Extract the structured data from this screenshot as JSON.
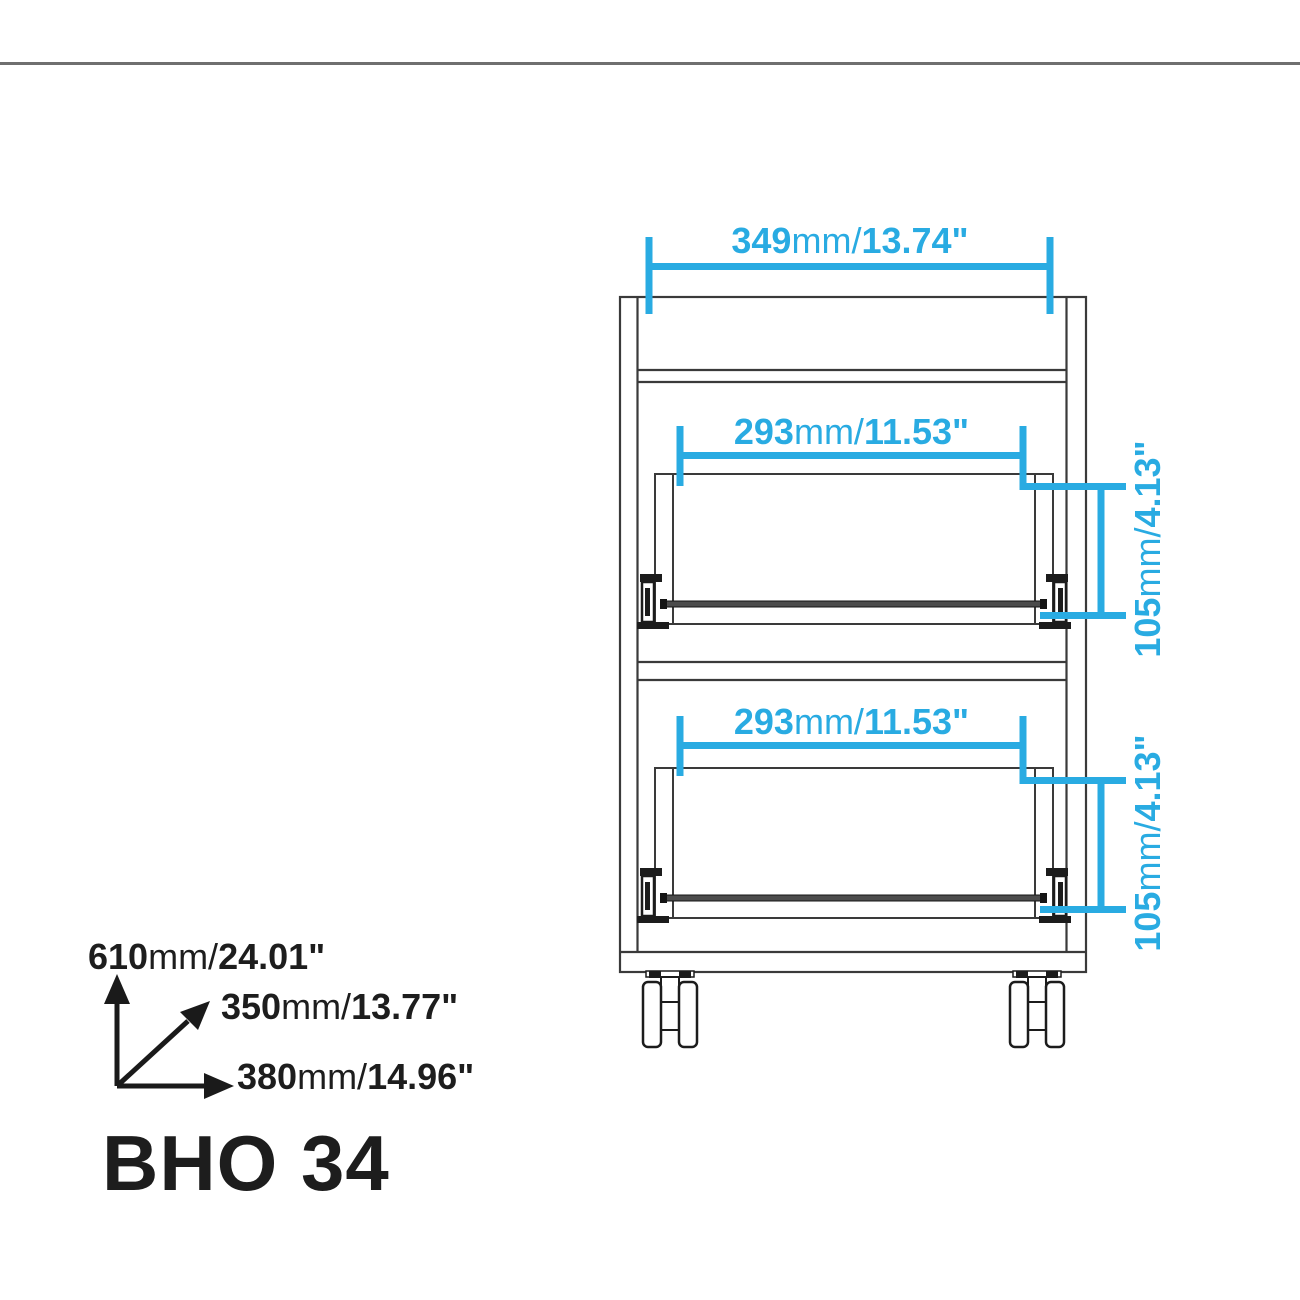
{
  "product": {
    "title": "BHO 34"
  },
  "colors": {
    "accent": "#29ABE2",
    "line": "#3a3a3a",
    "rule": "#6f6f6f",
    "text": "#1d1d1d"
  },
  "dimensions": {
    "top_width": {
      "value_mm": "349",
      "unit": "mm/",
      "value_in": "13.74\""
    },
    "drawer1_width": {
      "value_mm": "293",
      "unit": "mm/",
      "value_in": "11.53\""
    },
    "drawer1_height": {
      "value_mm": "105",
      "unit": "mm/",
      "value_in": "4.13\""
    },
    "drawer2_width": {
      "value_mm": "293",
      "unit": "mm/",
      "value_in": "11.53\""
    },
    "drawer2_height": {
      "value_mm": "105",
      "unit": "mm/",
      "value_in": "4.13\""
    },
    "overall_height": {
      "value_mm": "610",
      "unit": "mm/",
      "value_in": "24.01\""
    },
    "overall_depth": {
      "value_mm": "350",
      "unit": "mm/",
      "value_in": "13.77\""
    },
    "overall_width": {
      "value_mm": "380",
      "unit": "mm/",
      "value_in": "14.96\""
    }
  }
}
